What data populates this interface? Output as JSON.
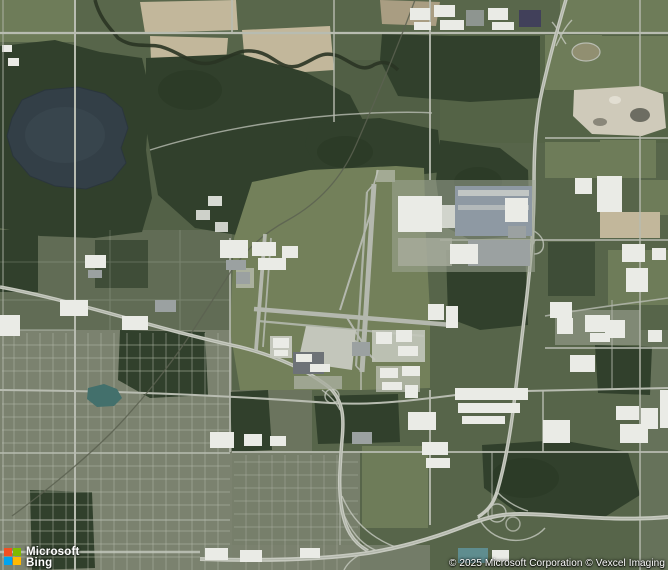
{
  "map": {
    "view_type": "aerial-satellite"
  },
  "logo": {
    "line1": "Microsoft",
    "line2": "Bing",
    "squares": {
      "red": "#f25022",
      "green": "#7fba00",
      "blue": "#00a4ef",
      "yellow": "#ffb900"
    }
  },
  "attribution": {
    "text": "© 2025 Microsoft Corporation © Vexcel Imaging"
  },
  "palette": {
    "base": "#57654a",
    "base_light": "#5d6b4d",
    "field_light": "#6e7c59",
    "tan": "#c2b79b",
    "tan_dark": "#a99d82",
    "forest": "#31402c",
    "forest_dark": "#273622",
    "airport_grass": "#73805a",
    "road": "#b8bcb1",
    "road_faint": "#a9ae9f",
    "highway": "#c6c9bf",
    "highway_median": "#9aa092",
    "runway": "#b4b8ae",
    "apron": "#c3c6bb",
    "pad": "#9fa596",
    "building_white": "#eaebe6",
    "roof_gray": "#9ba1a1",
    "roof_blue": "#8e99a3",
    "roof_teal": "#5f8d8f",
    "terminal": "#6d7277",
    "urban": "#7b826f",
    "urban_street": "#b4b9aa",
    "lake": "#333f47",
    "lake_light": "#3d4b54",
    "pond": "#43706c",
    "quarry": "#cfcaba",
    "quarry_dark": "#6d6d62",
    "quarry_light": "#e2ded2",
    "river": "#2a3423",
    "rail": "#5c6251",
    "solar": "#41405a"
  }
}
